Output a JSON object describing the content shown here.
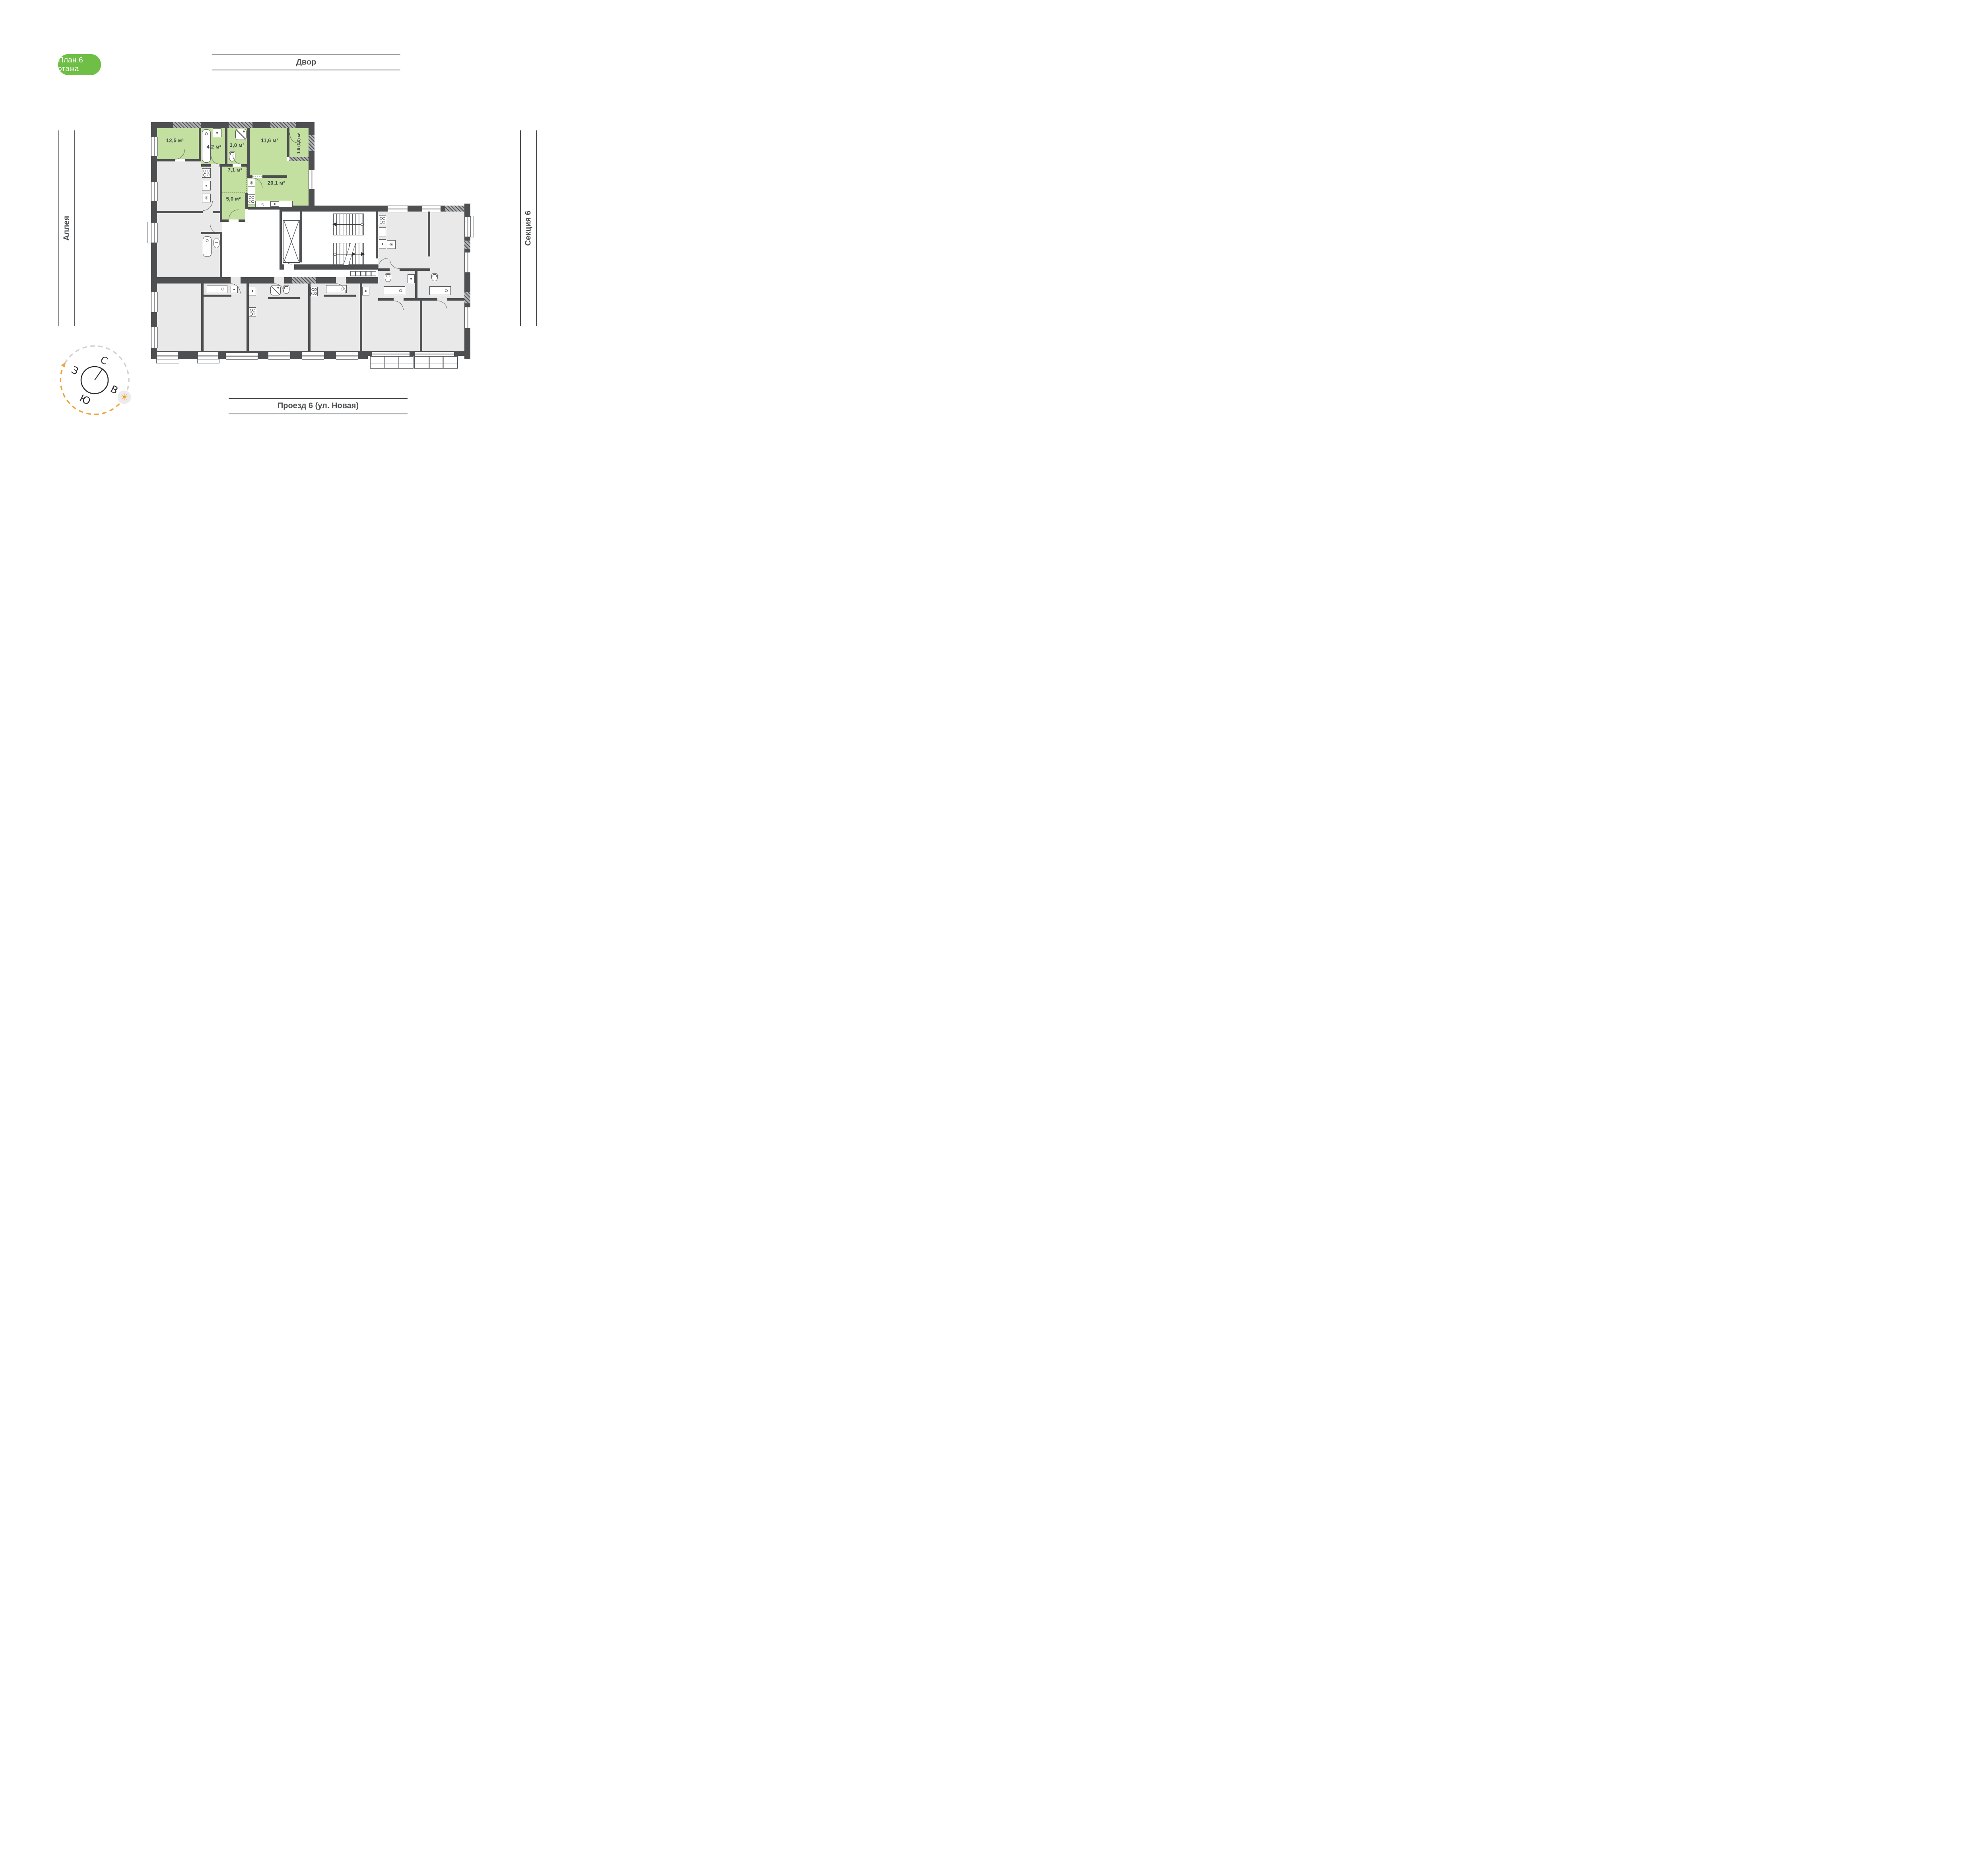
{
  "badge": {
    "label": "План 6 этажа"
  },
  "surroundings": {
    "top": "Двор",
    "left": "Аллея",
    "right": "Секция 6",
    "bottom": "Проезд 6 (ул. Новая)"
  },
  "compass": {
    "north": "С",
    "east": "В",
    "south": "Ю",
    "west": "З"
  },
  "apartment": {
    "highlighted": true,
    "rooms": [
      {
        "id": "room",
        "area": "12,5 м²"
      },
      {
        "id": "bathroom",
        "area": "4,2 м²"
      },
      {
        "id": "wc",
        "area": "3,0 м²"
      },
      {
        "id": "bedroom",
        "area": "11,6 м²"
      },
      {
        "id": "balcony",
        "area": "1,5 (3,0) м²"
      },
      {
        "id": "hallway",
        "area": "7,1 м²"
      },
      {
        "id": "wardrobe",
        "area": "5,0 м²"
      },
      {
        "id": "kitchen-living",
        "area": "20,1 м²"
      }
    ]
  },
  "icons": {
    "appliance": "✳",
    "faucet": "◁",
    "sun": "☀"
  },
  "colors": {
    "badge_green": "#6fbe45",
    "apartment_green": "#c3e0a1",
    "wall_dark": "#4d4f51",
    "unit_gray": "#e9e9e9",
    "accent_orange": "#f29b1c",
    "line_gray": "#4a4d4f"
  }
}
